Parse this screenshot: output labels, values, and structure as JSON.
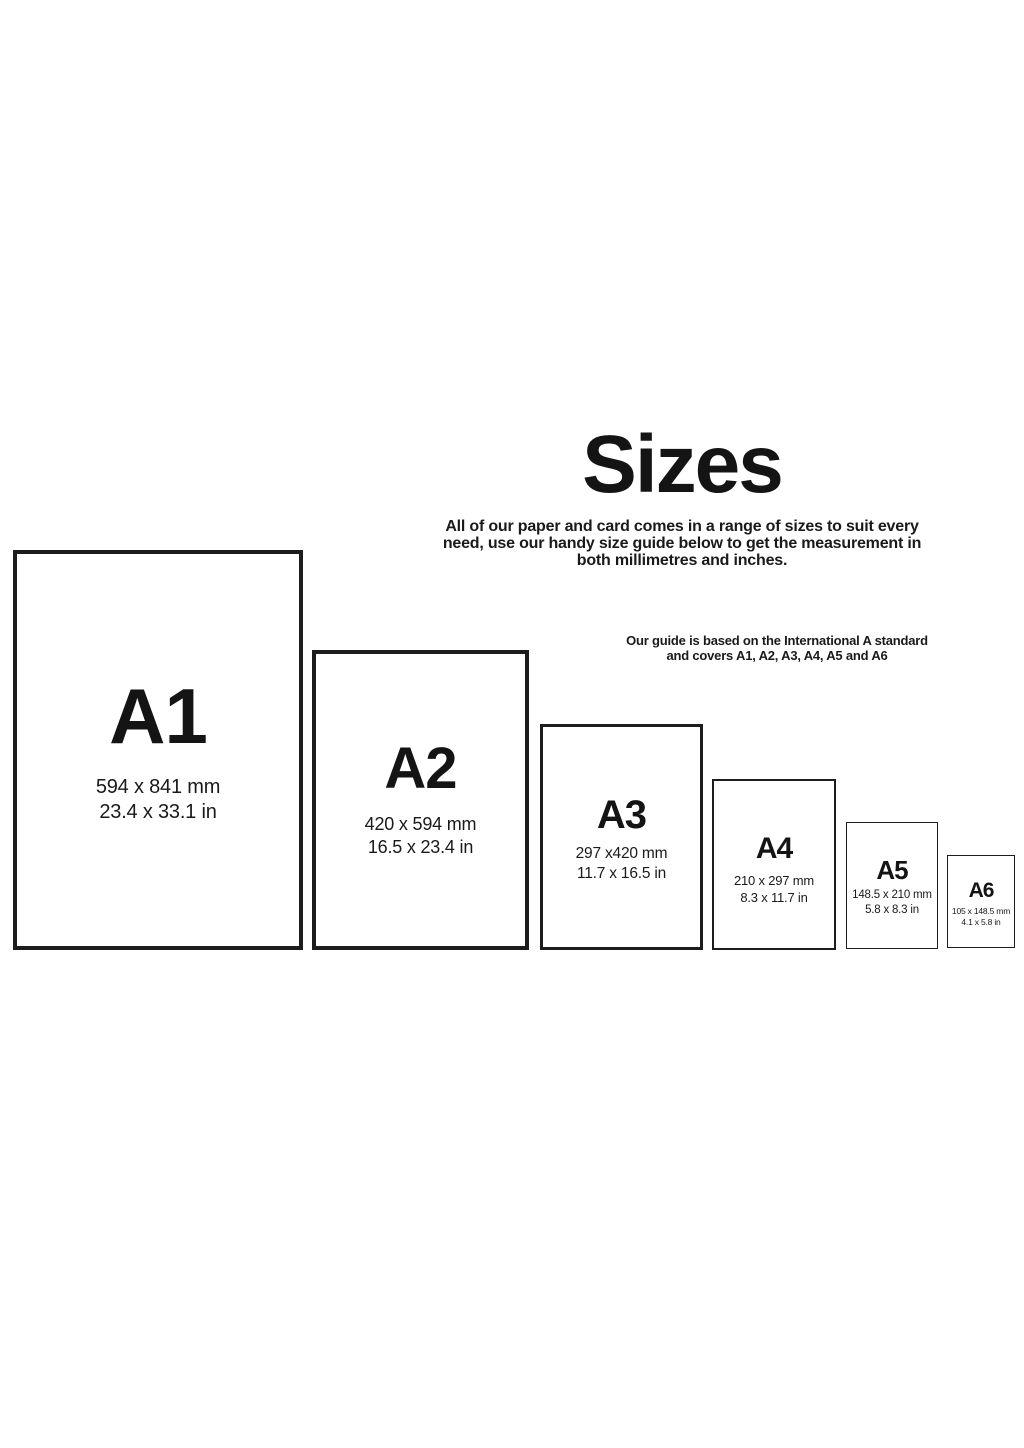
{
  "page": {
    "title": "Sizes",
    "subtitle": "All of our paper and card comes in a range of sizes to suit every\nneed, use our handy size guide below to get the measurement in\nboth millimetres and inches.",
    "note": "Our guide is based on the International A standard\nand covers A1, A2, A3, A4, A5 and A6"
  },
  "colors": {
    "background": "#ffffff",
    "text": "#161616",
    "paper_border": "#1d1d1d"
  },
  "sizes": [
    {
      "label": "A1",
      "mm": "594 x 841 mm",
      "inches": "23.4 x 33.1 in"
    },
    {
      "label": "A2",
      "mm": "420 x 594 mm",
      "inches": "16.5 x 23.4 in"
    },
    {
      "label": "A3",
      "mm": "297 x420 mm",
      "inches": "11.7 x 16.5 in"
    },
    {
      "label": "A4",
      "mm": "210 x 297 mm",
      "inches": "8.3 x 11.7 in"
    },
    {
      "label": "A5",
      "mm": "148.5 x 210 mm",
      "inches": "5.8 x 8.3 in"
    },
    {
      "label": "A6",
      "mm": "105 x 148.5 mm",
      "inches": "4.1 x 5.8 in"
    }
  ]
}
